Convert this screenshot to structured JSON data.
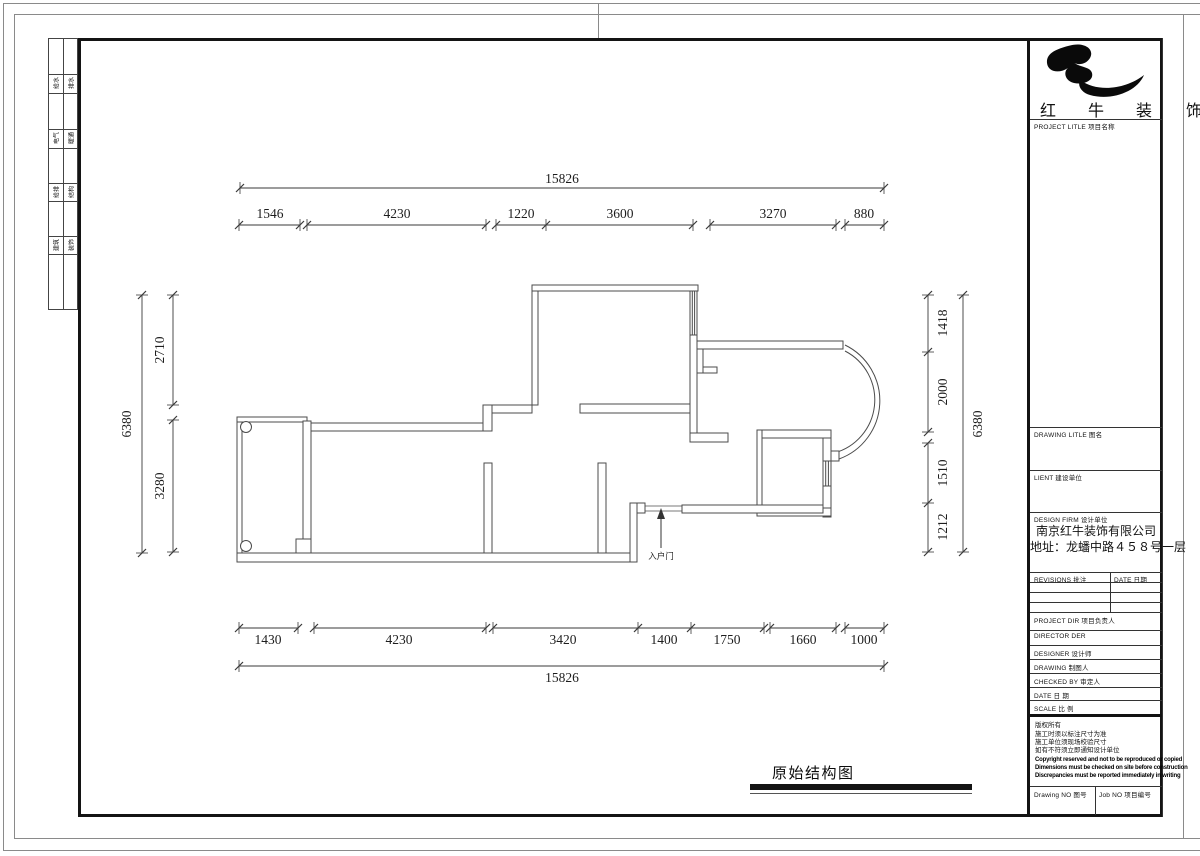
{
  "brand": {
    "name_chars": [
      "红",
      "牛",
      "装",
      "饰"
    ]
  },
  "side_strip": {
    "cells": [
      [
        "给水",
        "排水"
      ],
      [
        "电气",
        "暖通"
      ],
      [
        "给排",
        "结构"
      ],
      [
        "建筑",
        "装饰"
      ]
    ]
  },
  "title_block": {
    "project_title_label": "PROJECT LITLE  项目名称",
    "drawing_title_label": "DRAWING LITLE  图名",
    "client_label": "LIENT  建设单位",
    "design_firm_label": "DESIGN FIRM  设计单位",
    "company_name": "南京红牛装饰有限公司",
    "company_address": "地址：龙蟠中路４５８号一层",
    "revisions_label": "REVISIONS  批注",
    "date_col_label": "DATE  日期",
    "info_rows": [
      "PROJECT DIR   项目负责人",
      "DIRECTOR DER",
      "DESIGNER      设计师",
      "DRAWING       制图人",
      "CHECKED BY    审定人",
      "DATE          日  期",
      "SCALE         比  例"
    ],
    "copyright_cn": [
      "版权所有",
      "施工时须以标注尺寸为准",
      "施工单位须现场校验尺寸",
      "如有不符须立即通知设计单位"
    ],
    "copyright_en": [
      "Copyright reserved and not to be reproduced or copied",
      "Dimensions must be checked on site before construction",
      "Discrepancies must be reported immediately in writing"
    ],
    "drawing_no_label": "Drawing NO  图号",
    "job_no_label": "Job NO  项目编号"
  },
  "plan": {
    "title": "原始结构图",
    "entry_label": "入户门",
    "dimensions": {
      "top_total": "15826",
      "top_segments": [
        "1546",
        "4230",
        "1220",
        "3600",
        "3270",
        "880"
      ],
      "bottom_segments": [
        "1430",
        "4230",
        "3420",
        "1400",
        "1750",
        "1660",
        "1000"
      ],
      "bottom_total": "15826",
      "left_total": "6380",
      "left_segments": [
        "2710",
        "3280"
      ],
      "right_segments": [
        "1418",
        "2000",
        "1510",
        "1212"
      ],
      "right_total": "6380"
    }
  }
}
